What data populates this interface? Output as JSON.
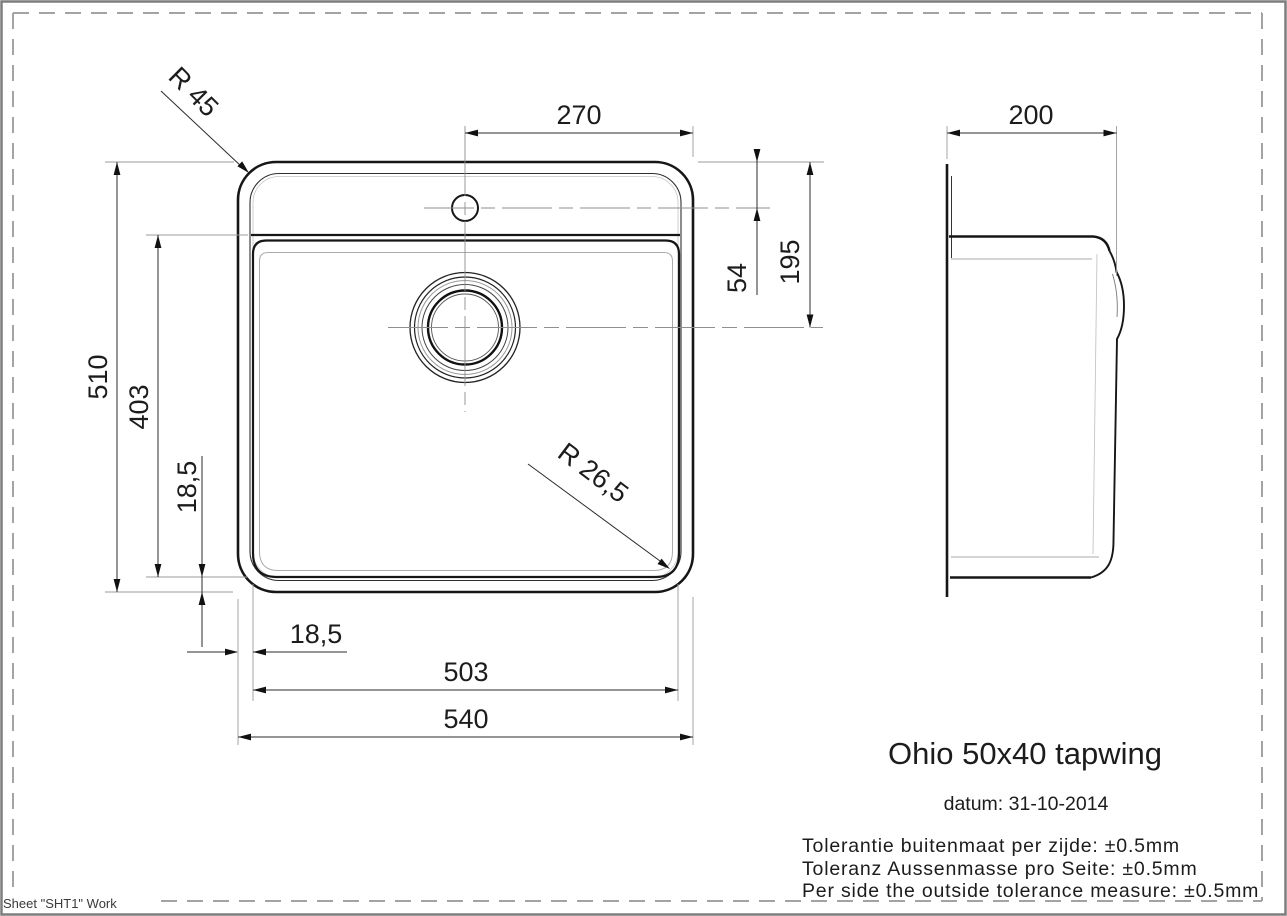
{
  "page": {
    "sheet_label": "Sheet \"SHT1\" Work"
  },
  "title_block": {
    "title": "Ohio 50x40 tapwing",
    "date": "datum: 31-10-2014",
    "tolerance_nl": "Tolerantie buitenmaat per zijde: ±0.5mm",
    "tolerance_de": "Toleranz Aussenmasse pro Seite: ±0.5mm",
    "tolerance_en": "Per side the outside tolerance measure: ±0.5mm"
  },
  "front_view": {
    "dim_tap_to_right_edge": "270",
    "dim_top_to_tap_center": "54",
    "dim_top_to_drain_center": "195",
    "dim_outer_height": "510",
    "dim_bowl_height": "403",
    "dim_bowl_bottom_inset": "18,5",
    "dim_bowl_left_inset": "18,5",
    "dim_bowl_width": "503",
    "dim_outer_width": "540",
    "radius_outer_corner": "R 45",
    "radius_bowl_corner": "R 26,5"
  },
  "side_view": {
    "dim_depth": "200"
  }
}
